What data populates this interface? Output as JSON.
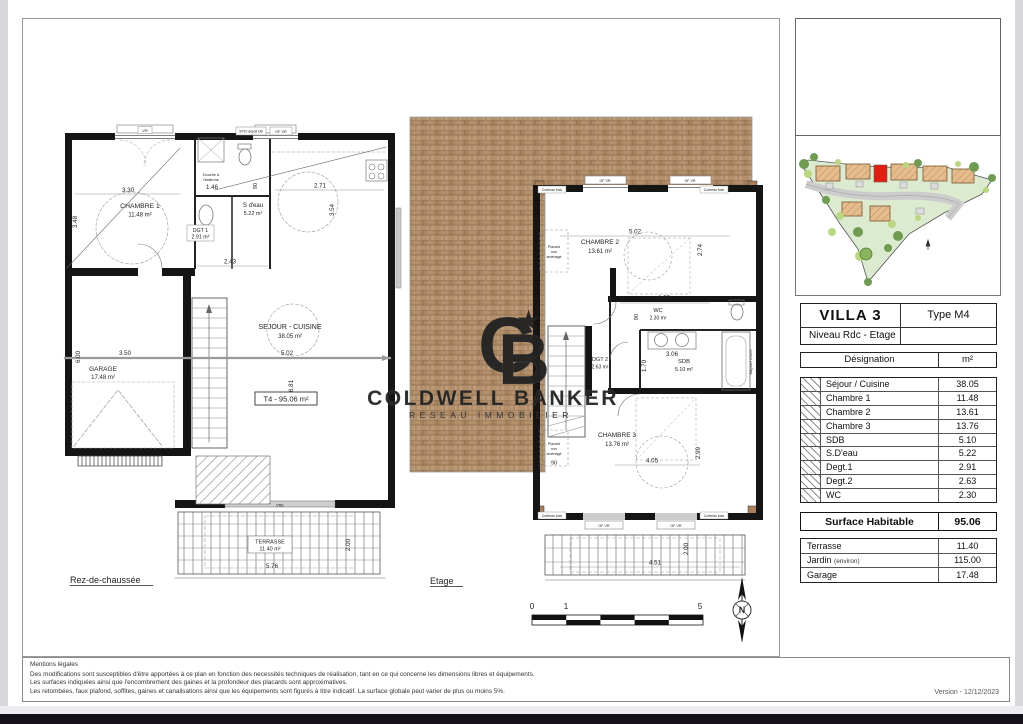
{
  "sheet": {
    "gf": {
      "title": "Rez-de-chaussée",
      "t4": "T4 - 95.06 m²",
      "chambre1": "CHAMBRE 1",
      "chambre1_a": "11.48 m²",
      "sdeau": "S d'eau",
      "sdeau_a": "5.22 m²",
      "dgt1": "DGT 1",
      "dgt1_a": "2.91 m²",
      "sejour": "SEJOUR - CUISINE",
      "sejour_a": "38.05 m²",
      "garage": "GARAGE",
      "garage_a": "17.48 m²",
      "terrasse": "TERRASSE",
      "terrasse_a": "11.40 m²",
      "douche1": "Douche à",
      "douche2": "l'italienne",
      "win_vr": "VR",
      "win_sp10": "SP10 dépoli OB",
      "win_gfvr": "GF VR",
      "win_vre": "VRE",
      "dims": {
        "a": "3.30",
        "b": "3.48",
        "c": "1.46",
        "d": "90",
        "e": "2.71",
        "f": "3.54",
        "g": "2.43",
        "h": "3.50",
        "i": "6.00",
        "j": "5.02",
        "k": "6.81",
        "l": "5.76",
        "m": "2.00"
      }
    },
    "et": {
      "title": "Etage",
      "chambre2": "CHAMBRE 2",
      "chambre2_a": "13.61 m²",
      "wc": "WC",
      "wc_a": "2.30 m²",
      "sdb": "SDB",
      "sdb_a": "5.10 m²",
      "dgt2": "DGT 2",
      "dgt2_a": "2.63 m²",
      "chambre3": "CHAMBRE 3",
      "chambre3_a": "13.76 m²",
      "placard1": "Placard",
      "placard2": "non",
      "placard3": "aménagé",
      "baignoire": "Baignoire 170x70",
      "corbeau": "Corbeau bois",
      "gfvr": "GF VR",
      "dims": {
        "a": "5.02",
        "b": "2.74",
        "c": "2.55",
        "d": "90",
        "e": "1.70",
        "f": "3.06",
        "g": "4.05",
        "h": "2.99",
        "i": "90",
        "j": "4.51",
        "k": "2.00"
      }
    },
    "scale": {
      "t0": "0",
      "t1": "1",
      "t5": "5"
    },
    "compass_n": "N"
  },
  "watermark": {
    "c": "C",
    "b": "B",
    "star": "★",
    "brand": "COLDWELL BANKER",
    "tagline": "RESEAU IMMOBILIER"
  },
  "panel": {
    "table": {
      "title": "VILLA 3",
      "type": "Type M4",
      "level": "Niveau Rdc - Etage",
      "col_designation": "Désignation",
      "col_unit": "m²",
      "rows": [
        {
          "label": "Séjour / Cuisine",
          "value": "38.05"
        },
        {
          "label": "Chambre 1",
          "value": "11.48"
        },
        {
          "label": "Chambre 2",
          "value": "13.61"
        },
        {
          "label": "Chambre 3",
          "value": "13.76"
        },
        {
          "label": "SDB",
          "value": "5.10"
        },
        {
          "label": "S.D'eau",
          "value": "5.22"
        },
        {
          "label": "Degt.1",
          "value": "2.91"
        },
        {
          "label": "Degt.2",
          "value": "2.63"
        },
        {
          "label": "WC",
          "value": "2.30"
        }
      ],
      "total_label": "Surface Habitable",
      "total_value": "95.06",
      "extras": [
        {
          "label": "Terrasse",
          "sub": "",
          "value": "11.40"
        },
        {
          "label": "Jardin",
          "sub": "(environ)",
          "value": "115.00"
        },
        {
          "label": "Garage",
          "sub": "",
          "value": "17.48"
        }
      ]
    }
  },
  "legal": {
    "title": "Mentions légales",
    "line1": "Des modifications sont susceptibles d'être apportées à ce plan en fonction des necessités techniques de réalisation, tant en ce qui concerne les dimensions libres et équipements.",
    "line2": "Les surfaces indiquées ainsi que l'encombrement des gaines et la profondeur des placards sont approximatives.",
    "line3": "Les retombées, faux plafond, soffites, gaines et canalisations ainsi que les équipements sont figurés à titre indicatif. La surface globale peut varier de plus ou moins 5%."
  },
  "footer": {
    "version": "Version  -  12/12/2023"
  }
}
